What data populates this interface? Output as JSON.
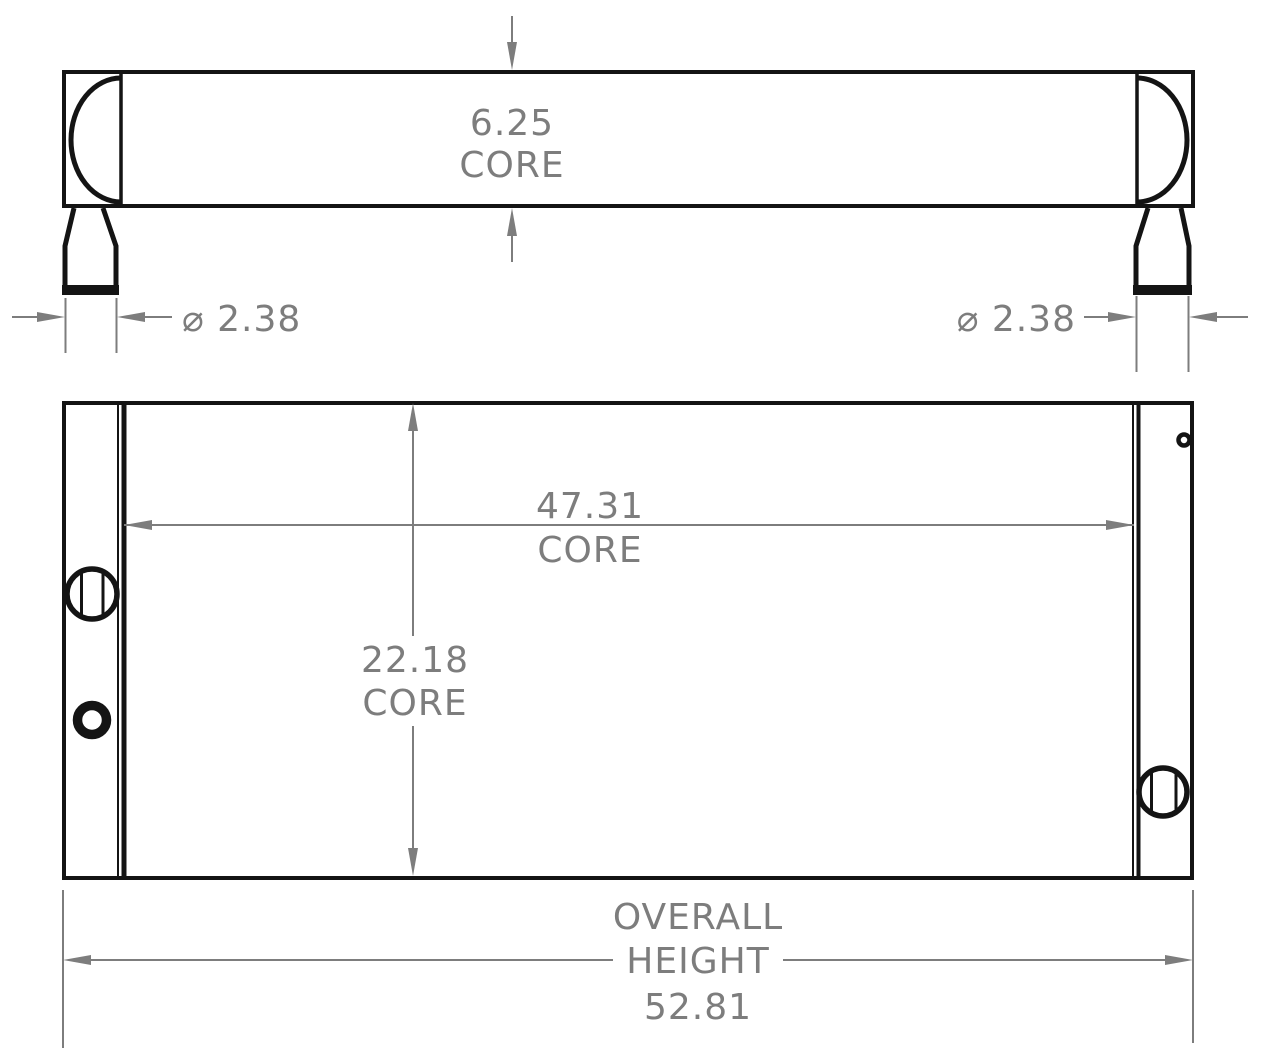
{
  "drawing": {
    "kind": "radiator-dimension-drawing",
    "views": {
      "top_view_name": "top-view",
      "front_view_name": "front-view"
    },
    "dimensions": {
      "core_depth": {
        "value": "6.25",
        "label": "CORE"
      },
      "port_left": {
        "value": "⌀ 2.38"
      },
      "port_right": {
        "value": "⌀ 2.38"
      },
      "core_width": {
        "value": "47.31",
        "label": "CORE"
      },
      "core_height": {
        "value": "22.18",
        "label": "CORE"
      },
      "overall_height": {
        "line1": "OVERALL",
        "line2": "HEIGHT",
        "value": "52.81"
      }
    },
    "colors": {
      "line": "#141414",
      "dimension": "#7d7d7d",
      "background": "#ffffff"
    }
  }
}
